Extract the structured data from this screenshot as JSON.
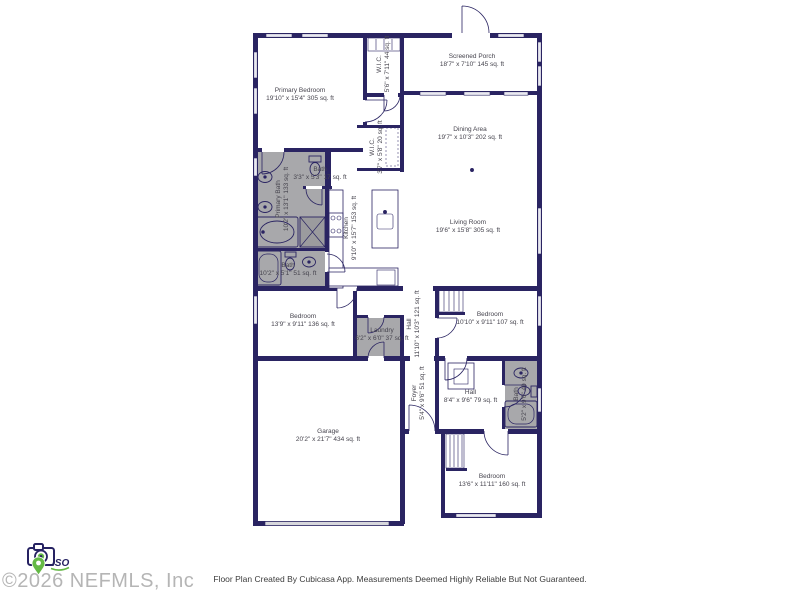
{
  "watermark": {
    "text": "©2026 NEFMLS, Inc",
    "iso_label": "ISO",
    "logo": "camera-location-pin-iso-logo"
  },
  "footer": {
    "disclaimer": "Floor Plan Created By Cubicasa App. Measurements Deemed Highly Reliable But Not Guaranteed."
  },
  "colors": {
    "wall": "#2a2462",
    "wet_room_fill": "#a8a8ab",
    "shower_fill": "#9b9b9e",
    "window_fill": "#e9e9f0",
    "garage_door_fill": "#d7d7dc",
    "label_text": "#46444e",
    "watermark_text": "#b5b5b5",
    "logo_green": "#64b945"
  },
  "rooms": [
    {
      "name": "Primary Bedroom",
      "dims": "19'10\" x 15'4\" 305 sq. ft"
    },
    {
      "name": "W.I.C.",
      "dims": "5'6\" x 7'11\" 44 sq. ft"
    },
    {
      "name": "Screened Porch",
      "dims": "18'7\" x 7'10\" 145 sq. ft"
    },
    {
      "name": "Dining Area",
      "dims": "19'7\" x 10'3\" 202 sq. ft"
    },
    {
      "name": "W.I.C.",
      "dims": "3'7\" x 5'8\" 20 sq. ft"
    },
    {
      "name": "Primary Bath",
      "dims": "10'2\" x 13'1\" 133 sq. ft"
    },
    {
      "name": "Bath",
      "dims": "3'3\" x 5'3\" 17 sq. ft"
    },
    {
      "name": "Kitchen",
      "dims": "9'10\" x 15'7\" 153 sq. ft"
    },
    {
      "name": "Living Room",
      "dims": "19'6\" x 15'8\" 305 sq. ft"
    },
    {
      "name": "Bath",
      "dims": "10'2\" x 5'1\" 51 sq. ft"
    },
    {
      "name": "Bedroom",
      "dims": "13'9\" x 9'11\" 136 sq. ft"
    },
    {
      "name": "Laundry",
      "dims": "6'2\" x 6'0\" 37 sq. ft"
    },
    {
      "name": "Hall",
      "dims": "11'10\" x 10'3\" 121 sq. ft"
    },
    {
      "name": "Bedroom",
      "dims": "10'10\" x 9'11\" 107 sq. ft"
    },
    {
      "name": "Foyer",
      "dims": "5'4\" x 9'6\" 51 sq. ft"
    },
    {
      "name": "Hall",
      "dims": "8'4\" x 9'6\" 79 sq. ft"
    },
    {
      "name": "Bath",
      "dims": "5'2\" x 9'6\" 49 sq. ft"
    },
    {
      "name": "Garage",
      "dims": "20'2\" x 21'7\" 434 sq. ft"
    },
    {
      "name": "Bedroom",
      "dims": "13'6\" x 11'11\" 160 sq. ft"
    }
  ]
}
